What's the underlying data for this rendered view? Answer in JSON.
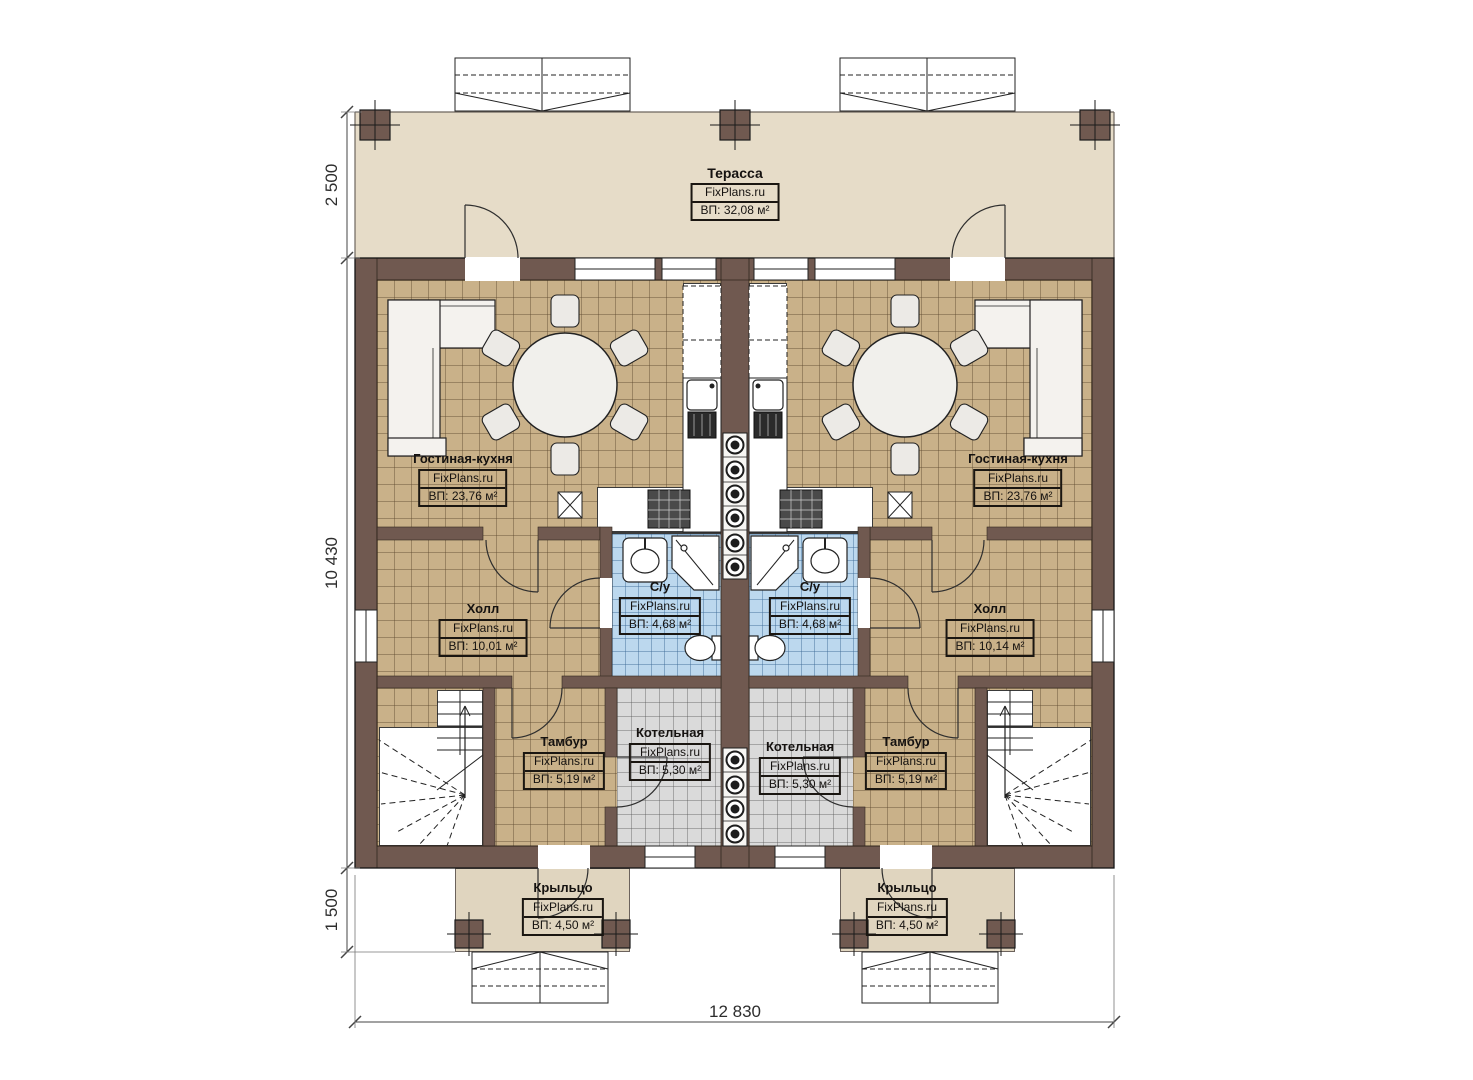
{
  "plan_title": "Floor plan of a duplex house, first floor",
  "rooms": {
    "terrace": {
      "name": "Терасса",
      "brand": "FixPlans.ru",
      "area": "ВП: 32,08 м²"
    },
    "living_left": {
      "name": "Гостиная-кухня",
      "brand": "FixPlans.ru",
      "area": "ВП: 23,76 м²"
    },
    "living_right": {
      "name": "Гостиная-кухня",
      "brand": "FixPlans.ru",
      "area": "ВП: 23,76 м²"
    },
    "bath_left": {
      "name": "С/у",
      "brand": "FixPlans.ru",
      "area": "ВП: 4,68 м²"
    },
    "bath_right": {
      "name": "С/у",
      "brand": "FixPlans.ru",
      "area": "ВП: 4,68 м²"
    },
    "hall_left": {
      "name": "Холл",
      "brand": "FixPlans.ru",
      "area": "ВП: 10,01 м²"
    },
    "hall_right": {
      "name": "Холл",
      "brand": "FixPlans.ru",
      "area": "ВП: 10,14 м²"
    },
    "vestibule_left": {
      "name": "Тамбур",
      "brand": "FixPlans.ru",
      "area": "ВП: 5,19 м²"
    },
    "vestibule_right": {
      "name": "Тамбур",
      "brand": "FixPlans.ru",
      "area": "ВП: 5,19 м²"
    },
    "boiler_left": {
      "name": "Котельная",
      "brand": "FixPlans.ru",
      "area": "ВП: 5,30 м²"
    },
    "boiler_right": {
      "name": "Котельная",
      "brand": "FixPlans.ru",
      "area": "ВП: 5,30 м²"
    },
    "porch_left": {
      "name": "Крыльцо",
      "brand": "FixPlans.ru",
      "area": "ВП: 4,50 м²"
    },
    "porch_right": {
      "name": "Крыльцо",
      "brand": "FixPlans.ru",
      "area": "ВП: 4,50 м²"
    }
  },
  "dimensions": {
    "terrace_depth": "2 500",
    "house_depth": "10 430",
    "porch_depth": "1 500",
    "total_width": "12 830"
  },
  "colors": {
    "wall": "#705950",
    "floor_tile_tan": "#c9b189",
    "floor_tile_blue": "#bcd8ee",
    "floor_tile_gray": "#dadada",
    "terrace_floor": "#e6dcc8",
    "porch_floor": "#e0d5bf"
  }
}
